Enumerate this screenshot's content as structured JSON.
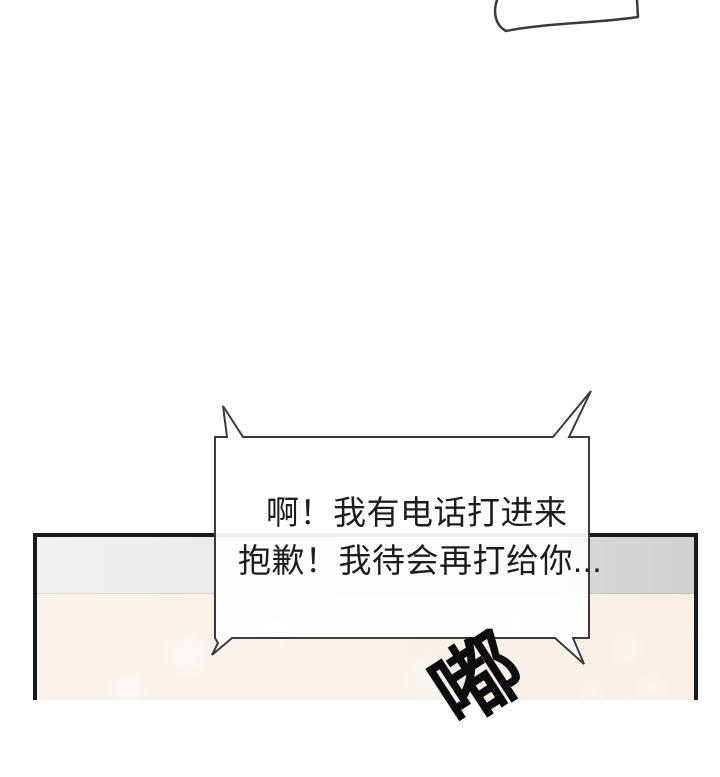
{
  "page": {
    "type": "webtoon-comic-panel",
    "background_color": "#ffffff"
  },
  "top_partial_bubble": {
    "border_color": "#3b3b3b",
    "fill_color": "#ffffff"
  },
  "speech_bubble": {
    "lines": [
      "啊！我有电话打进来",
      "抱歉！我待会再打给你..."
    ],
    "fill_color": "#ffffff",
    "border_color": "#3b3b3b",
    "text_color": "#1d1d1d"
  },
  "sound_effect": {
    "text": "嘟",
    "color": "#0d0d0d"
  },
  "panel": {
    "border_color": "#1a1a1a",
    "wall_band_color_left": "#f1f0ee",
    "wall_band_color_right": "#d2d0cf",
    "floor_color": "#f8f2ea"
  }
}
